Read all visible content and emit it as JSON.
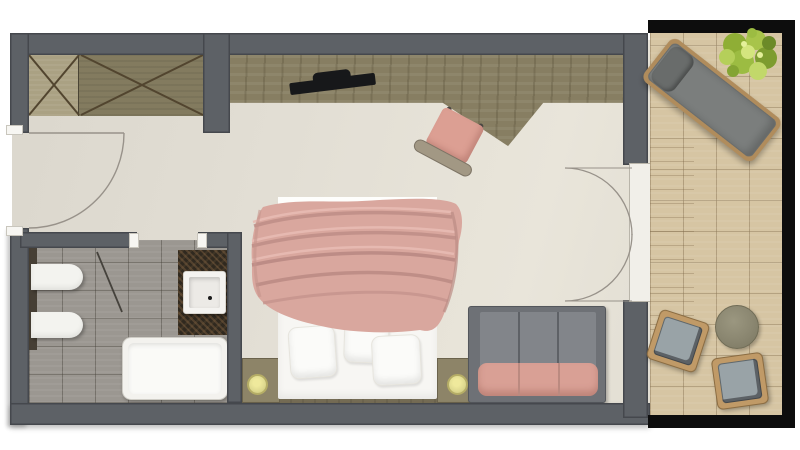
{
  "meta": {
    "title": "Hotel room floor plan",
    "view": "top-down rendered plan",
    "width_px": 800,
    "height_px": 450
  },
  "palette": {
    "background": "#ffffff",
    "wall": "#5d6166",
    "wall_outline": "#45484d",
    "floor_bedroom": "#e2ded4",
    "floor_bath_tile": "#9b9791",
    "wood_desk": "#877e62",
    "wood_closet_light": "#aaa183",
    "wood_closet_dark": "#837b5f",
    "bed_white": "#f7f6f3",
    "duvet_pink": "#d9a79e",
    "duvet_highlight": "#e7bbb2",
    "duvet_shadow": "#bb8c85",
    "sofa_frame": "#6e7176",
    "sofa_back": "#82858a",
    "sofa_seat_pink": "#d9a095",
    "chair_pink": "#dc9f93",
    "vanity_mosaic": "#30291f",
    "fixture_white": "#f3f3ef",
    "lamp_gold": "#ded98f",
    "balcony_tile": "#d6c5a3",
    "railing_black": "#0d0d0d",
    "lounger_gray": "#7b7e7d",
    "outdoor_wood": "#b08c5c",
    "stool_cushion": "#99a3a7",
    "table_olive": "#8a8670",
    "plant_green": "#9cbc42",
    "tv_black": "#17181a",
    "door_arc": "#98928a"
  },
  "rooms": {
    "bedroom": {
      "label": "Bedroom"
    },
    "entry": {
      "label": "Entry hall with wardrobe"
    },
    "bathroom": {
      "label": "Bathroom"
    },
    "balcony": {
      "label": "Balcony terrace"
    }
  },
  "doors": {
    "entry": {
      "label": "Entry door with 90-degree swing arc"
    },
    "bathroom": {
      "label": "Bathroom door leaf"
    },
    "balcony": {
      "label": "Double balcony doors with swing arcs"
    }
  },
  "furniture": {
    "wardrobe": {
      "label": "Built-in wardrobe, two cross-marked sections"
    },
    "desk": {
      "label": "Wall desk and media console with angled front"
    },
    "tv": {
      "label": "Flat-screen TV on console"
    },
    "desk_chair": {
      "label": "Pink desk chair"
    },
    "bed": {
      "label": "Double bed with white linen"
    },
    "bed_sheet": {
      "label": "Folded sheet edge"
    },
    "duvet": {
      "label": "Pink draped duvet"
    },
    "pillow_1": {
      "label": "Pillow left"
    },
    "pillow_2": {
      "label": "Pillow middle"
    },
    "pillow_3": {
      "label": "Pillow right"
    },
    "bed_platform": {
      "label": "Wooden bed platform"
    },
    "nightstand_left": {
      "label": "Left nightstand"
    },
    "nightstand_right": {
      "label": "Right nightstand"
    },
    "lamp_left": {
      "label": "Left bedside lamp"
    },
    "lamp_right": {
      "label": "Right bedside lamp"
    },
    "sofa": {
      "label": "Gray sofa with pink seat cushion"
    },
    "toilet": {
      "label": "Toilet"
    },
    "bidet": {
      "label": "Bidet"
    },
    "vanity": {
      "label": "Mosaic vanity counter"
    },
    "washbasin": {
      "label": "Square washbasin"
    },
    "shower": {
      "label": "Shower tray"
    },
    "shower_screen": {
      "label": "Glass screen line"
    },
    "sun_lounger": {
      "label": "Sun lounger with headrest"
    },
    "plant": {
      "label": "Potted plant"
    },
    "side_table": {
      "label": "Round outdoor side table"
    },
    "stool_1": {
      "label": "Outdoor stool upper"
    },
    "stool_2": {
      "label": "Outdoor stool lower"
    },
    "railing": {
      "label": "Balcony railing"
    }
  }
}
